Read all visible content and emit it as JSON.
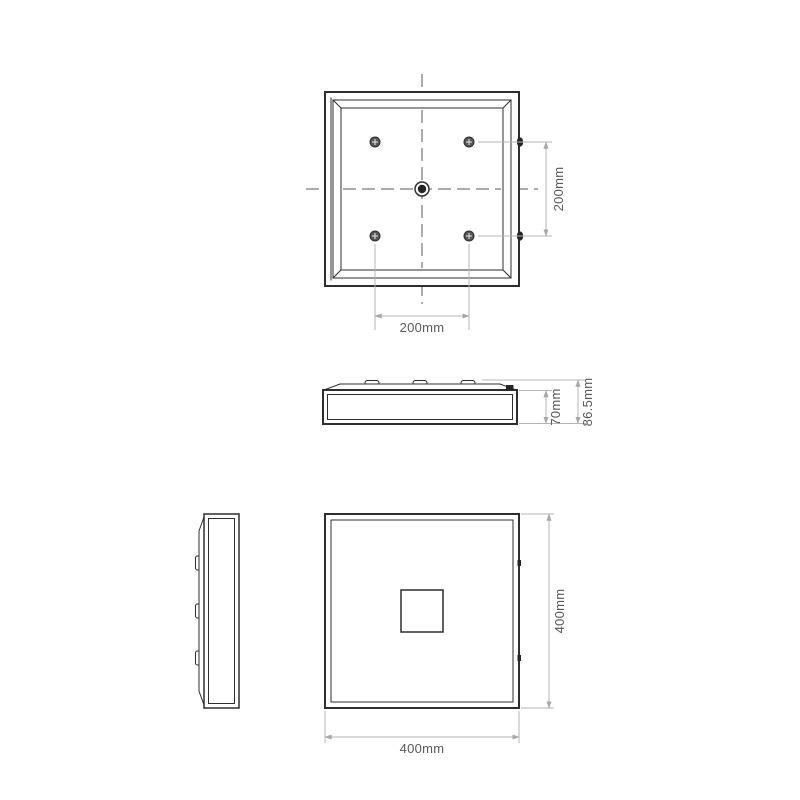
{
  "colors": {
    "line": "#2e2e30",
    "centerline": "#5a5a5a",
    "dimension_line": "#b4b6b8",
    "dimension_text": "#58595b",
    "background": "#ffffff"
  },
  "icons": {
    "screw": "phillips-screw-icon",
    "center_fixing": "center-fixing-icon",
    "mounting_clip": "mounting-clip-icon"
  },
  "dimensions": {
    "top_view": {
      "vertical": "200mm",
      "horizontal": "200mm"
    },
    "side_view": {
      "inner": "70mm",
      "overall": "86.5mm"
    },
    "front_view": {
      "vertical": "400mm",
      "horizontal": "400mm"
    }
  }
}
